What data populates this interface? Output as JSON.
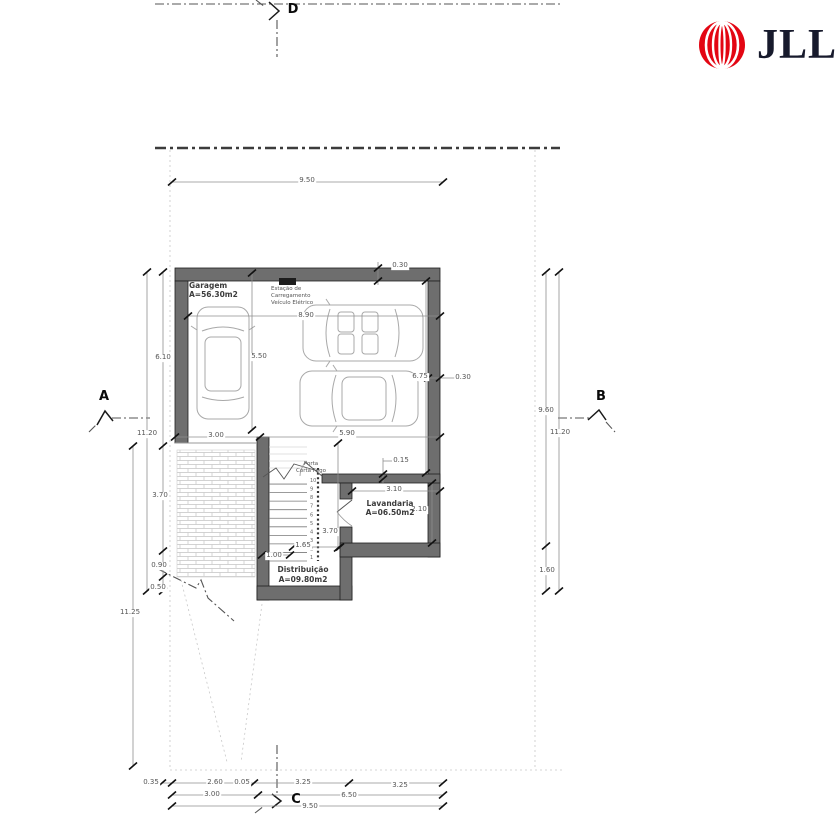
{
  "logo": {
    "brand": "JLL"
  },
  "colors": {
    "accent_red": "#E30613",
    "logo_navy": "#171A2C",
    "wall_gray": "#6E6E6E"
  },
  "plan": {
    "rooms": {
      "garagem": {
        "name": "Garagem",
        "area": "A=56.30m2"
      },
      "lavandaria": {
        "name": "Lavandaria",
        "area": "A=06.50m2"
      },
      "distribuicao": {
        "name": "Distribuição",
        "area": "A=09.80m2"
      }
    },
    "annotations": {
      "ev_line1": "Estação de",
      "ev_line2": "Carregamento",
      "ev_line3": "Veículo Elétrico",
      "fire_door_line1": "Porta",
      "fire_door_line2": "Corta Fogo"
    },
    "sections": {
      "a": "A",
      "b": "B",
      "c": "C",
      "d": "D"
    },
    "stairs": {
      "numbers": [
        "1",
        "2",
        "3",
        "4",
        "5",
        "6",
        "7",
        "8",
        "9",
        "10"
      ]
    },
    "dimensions": {
      "top_width": "9.50",
      "garage_width": "8.90",
      "top_wall": "0.30",
      "garage_height_left": "6.10",
      "car_bay": "5.50",
      "left_total": "11.20",
      "door_width": "3.00",
      "garage_bottom": "5.90",
      "garage_height_right": "6.75",
      "right_wall": "0.30",
      "right_upper": "9.60",
      "right_total": "11.20",
      "right_lower": "1.60",
      "lav_wall": "0.15",
      "lav_width": "3.10",
      "lav_height": "2.10",
      "left_lower": "3.70",
      "stair_height": "3.70",
      "stair_run": "1.65",
      "stair_width": "1.00",
      "left_s1": "0.90",
      "left_s2": "0.50",
      "left_outer": "11.25",
      "b1": "0.35",
      "b2": "2.60",
      "b3": "0.05",
      "b4": "3.25",
      "b5": "3.25",
      "b6": "3.00",
      "b7": "6.50",
      "b8": "9.50"
    }
  }
}
